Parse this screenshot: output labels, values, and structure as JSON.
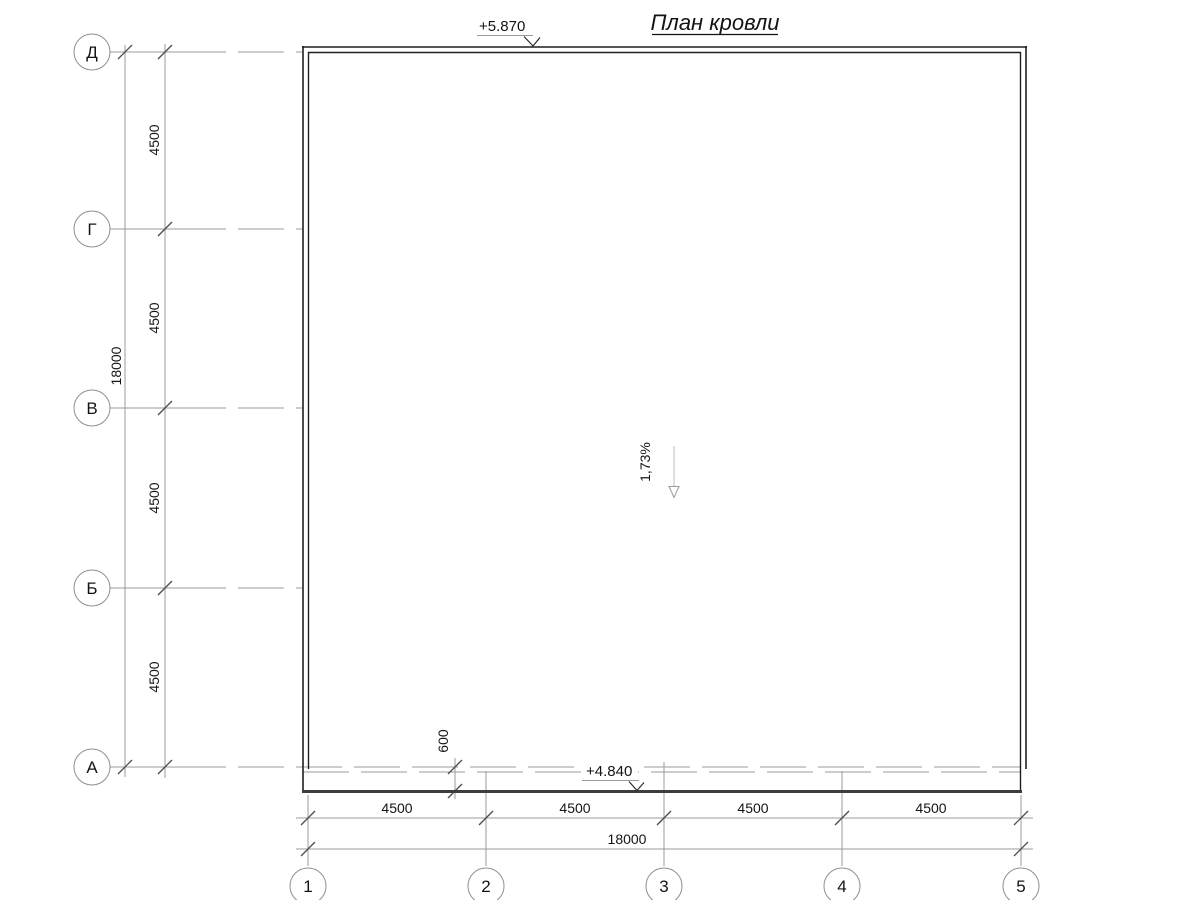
{
  "title": "План кровли",
  "elevation_marks": {
    "roof_top": "+5.870",
    "eave": "+4.840"
  },
  "slope_arrow": {
    "label": "1,73%"
  },
  "axes": {
    "rows": [
      "Д",
      "Г",
      "В",
      "Б",
      "А"
    ],
    "cols": [
      "1",
      "2",
      "3",
      "4",
      "5"
    ]
  },
  "dimensions": {
    "left": {
      "segments": [
        "4500",
        "4500",
        "4500",
        "4500"
      ],
      "total": "18000"
    },
    "bottom": {
      "segments": [
        "4500",
        "4500",
        "4500",
        "4500"
      ],
      "total": "18000"
    },
    "eave_offset": "600"
  },
  "colors": {
    "background": "#ffffff",
    "wall_line": "#1f1f1f",
    "eave_line": "#3d3d3d",
    "aux_line": "#9b9b9b",
    "tick": "#4d4d4d",
    "text": "#141414",
    "slope_line": "#bdbdbd"
  }
}
